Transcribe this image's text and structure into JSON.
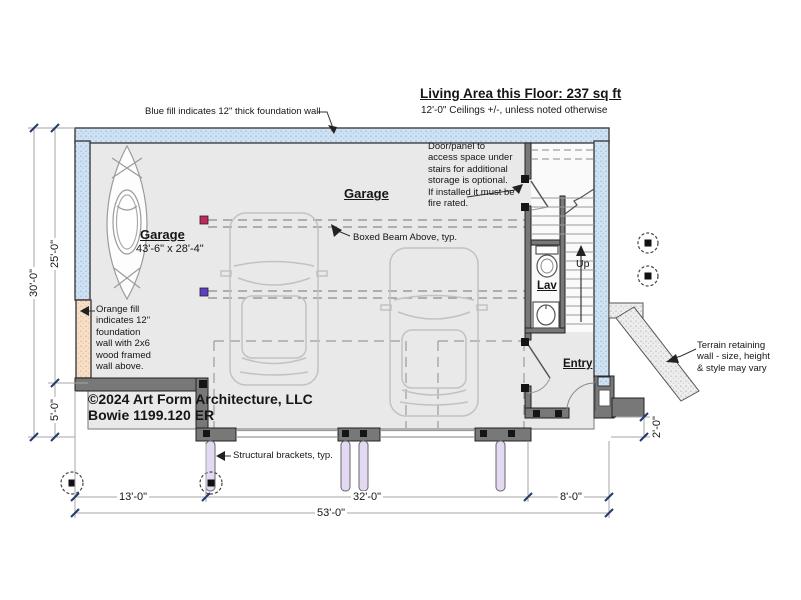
{
  "plan": {
    "title": "Living Area this Floor: 237 sq ft",
    "subtitle": "12'-0\" Ceilings +/-, unless noted otherwise",
    "rooms": {
      "garage": "Garage",
      "garage_size": "43'-6\" x 28'-4\"",
      "garage2": "Garage",
      "lav": "Lav",
      "entry": "Entry",
      "up": "Up"
    },
    "notes": {
      "blue_wall": "Blue fill indicates 12\" thick foundation wall",
      "under_stairs": "Door/panel to\naccess space under\nstairs for additional\nstorage is optional.\nIf installed it must be\nfire rated.",
      "boxed_beam": "Boxed Beam Above, typ.",
      "orange_wall": "Orange fill\nindicates 12\"\nfoundation\nwall with 2x6\nwood framed\nwall above.",
      "brackets": "Structural brackets, typ.",
      "terrain": "Terrain retaining\nwall - size, height\n& style may vary"
    },
    "copyright_line1": "©2024 Art Form Architecture, LLC",
    "copyright_line2": "Bowie 1199.120 ER",
    "dims": {
      "overall_depth": "30'-0\"",
      "main_depth": "25'-0\"",
      "porch_depth": "5'-0\"",
      "left_bay": "13'-0\"",
      "center_bay": "32'-0\"",
      "right_bay": "8'-0\"",
      "overall_width": "53'-0\"",
      "entry_step": "2'-0\""
    },
    "colors": {
      "foundation_blue": "#cfe2f3",
      "foundation_orange": "#f8dfc8",
      "framed_wall_gray": "#787878",
      "bracket_lavender": "#e3d9f2"
    }
  }
}
